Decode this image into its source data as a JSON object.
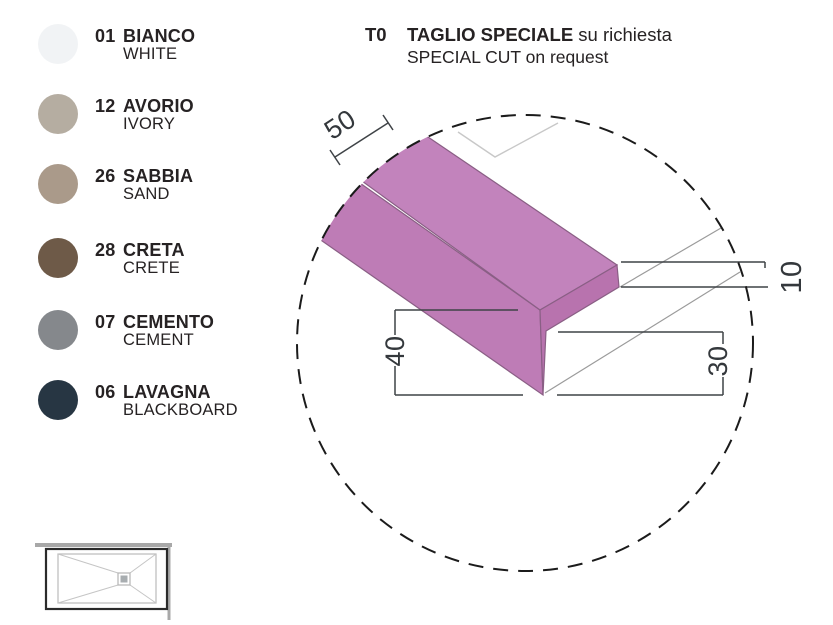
{
  "colors_panel": {
    "items": [
      {
        "code": "01",
        "name_it": "BIANCO",
        "name_en": "WHITE",
        "hex": "#f1f3f5"
      },
      {
        "code": "12",
        "name_it": "AVORIO",
        "name_en": "IVORY",
        "hex": "#b5ada1"
      },
      {
        "code": "26",
        "name_it": "SABBIA",
        "name_en": "SAND",
        "hex": "#aa9a8a"
      },
      {
        "code": "28",
        "name_it": "CRETA",
        "name_en": "CRETE",
        "hex": "#6e5a48"
      },
      {
        "code": "07",
        "name_it": "CEMENTO",
        "name_en": "CEMENT",
        "hex": "#85888c"
      },
      {
        "code": "06",
        "name_it": "LAVAGNA",
        "name_en": "BLACKBOARD",
        "hex": "#273643"
      }
    ]
  },
  "title": {
    "code": "T0",
    "line1_bold": "TAGLIO SPECIALE",
    "line1_regular": " su richiesta",
    "line2": "SPECIAL CUT on request"
  },
  "diagram": {
    "dimensions": {
      "top_width": "50",
      "front_height": "40",
      "lower_height": "30",
      "thickness": "10"
    },
    "shape_colors": {
      "top": "#c283bc",
      "front": "#be7cb6",
      "end": "#b873ae",
      "edge": "#8a5f85"
    },
    "icons": [
      "magnifier-dashed-circle-icon",
      "shower-tray-plan-icon"
    ]
  }
}
